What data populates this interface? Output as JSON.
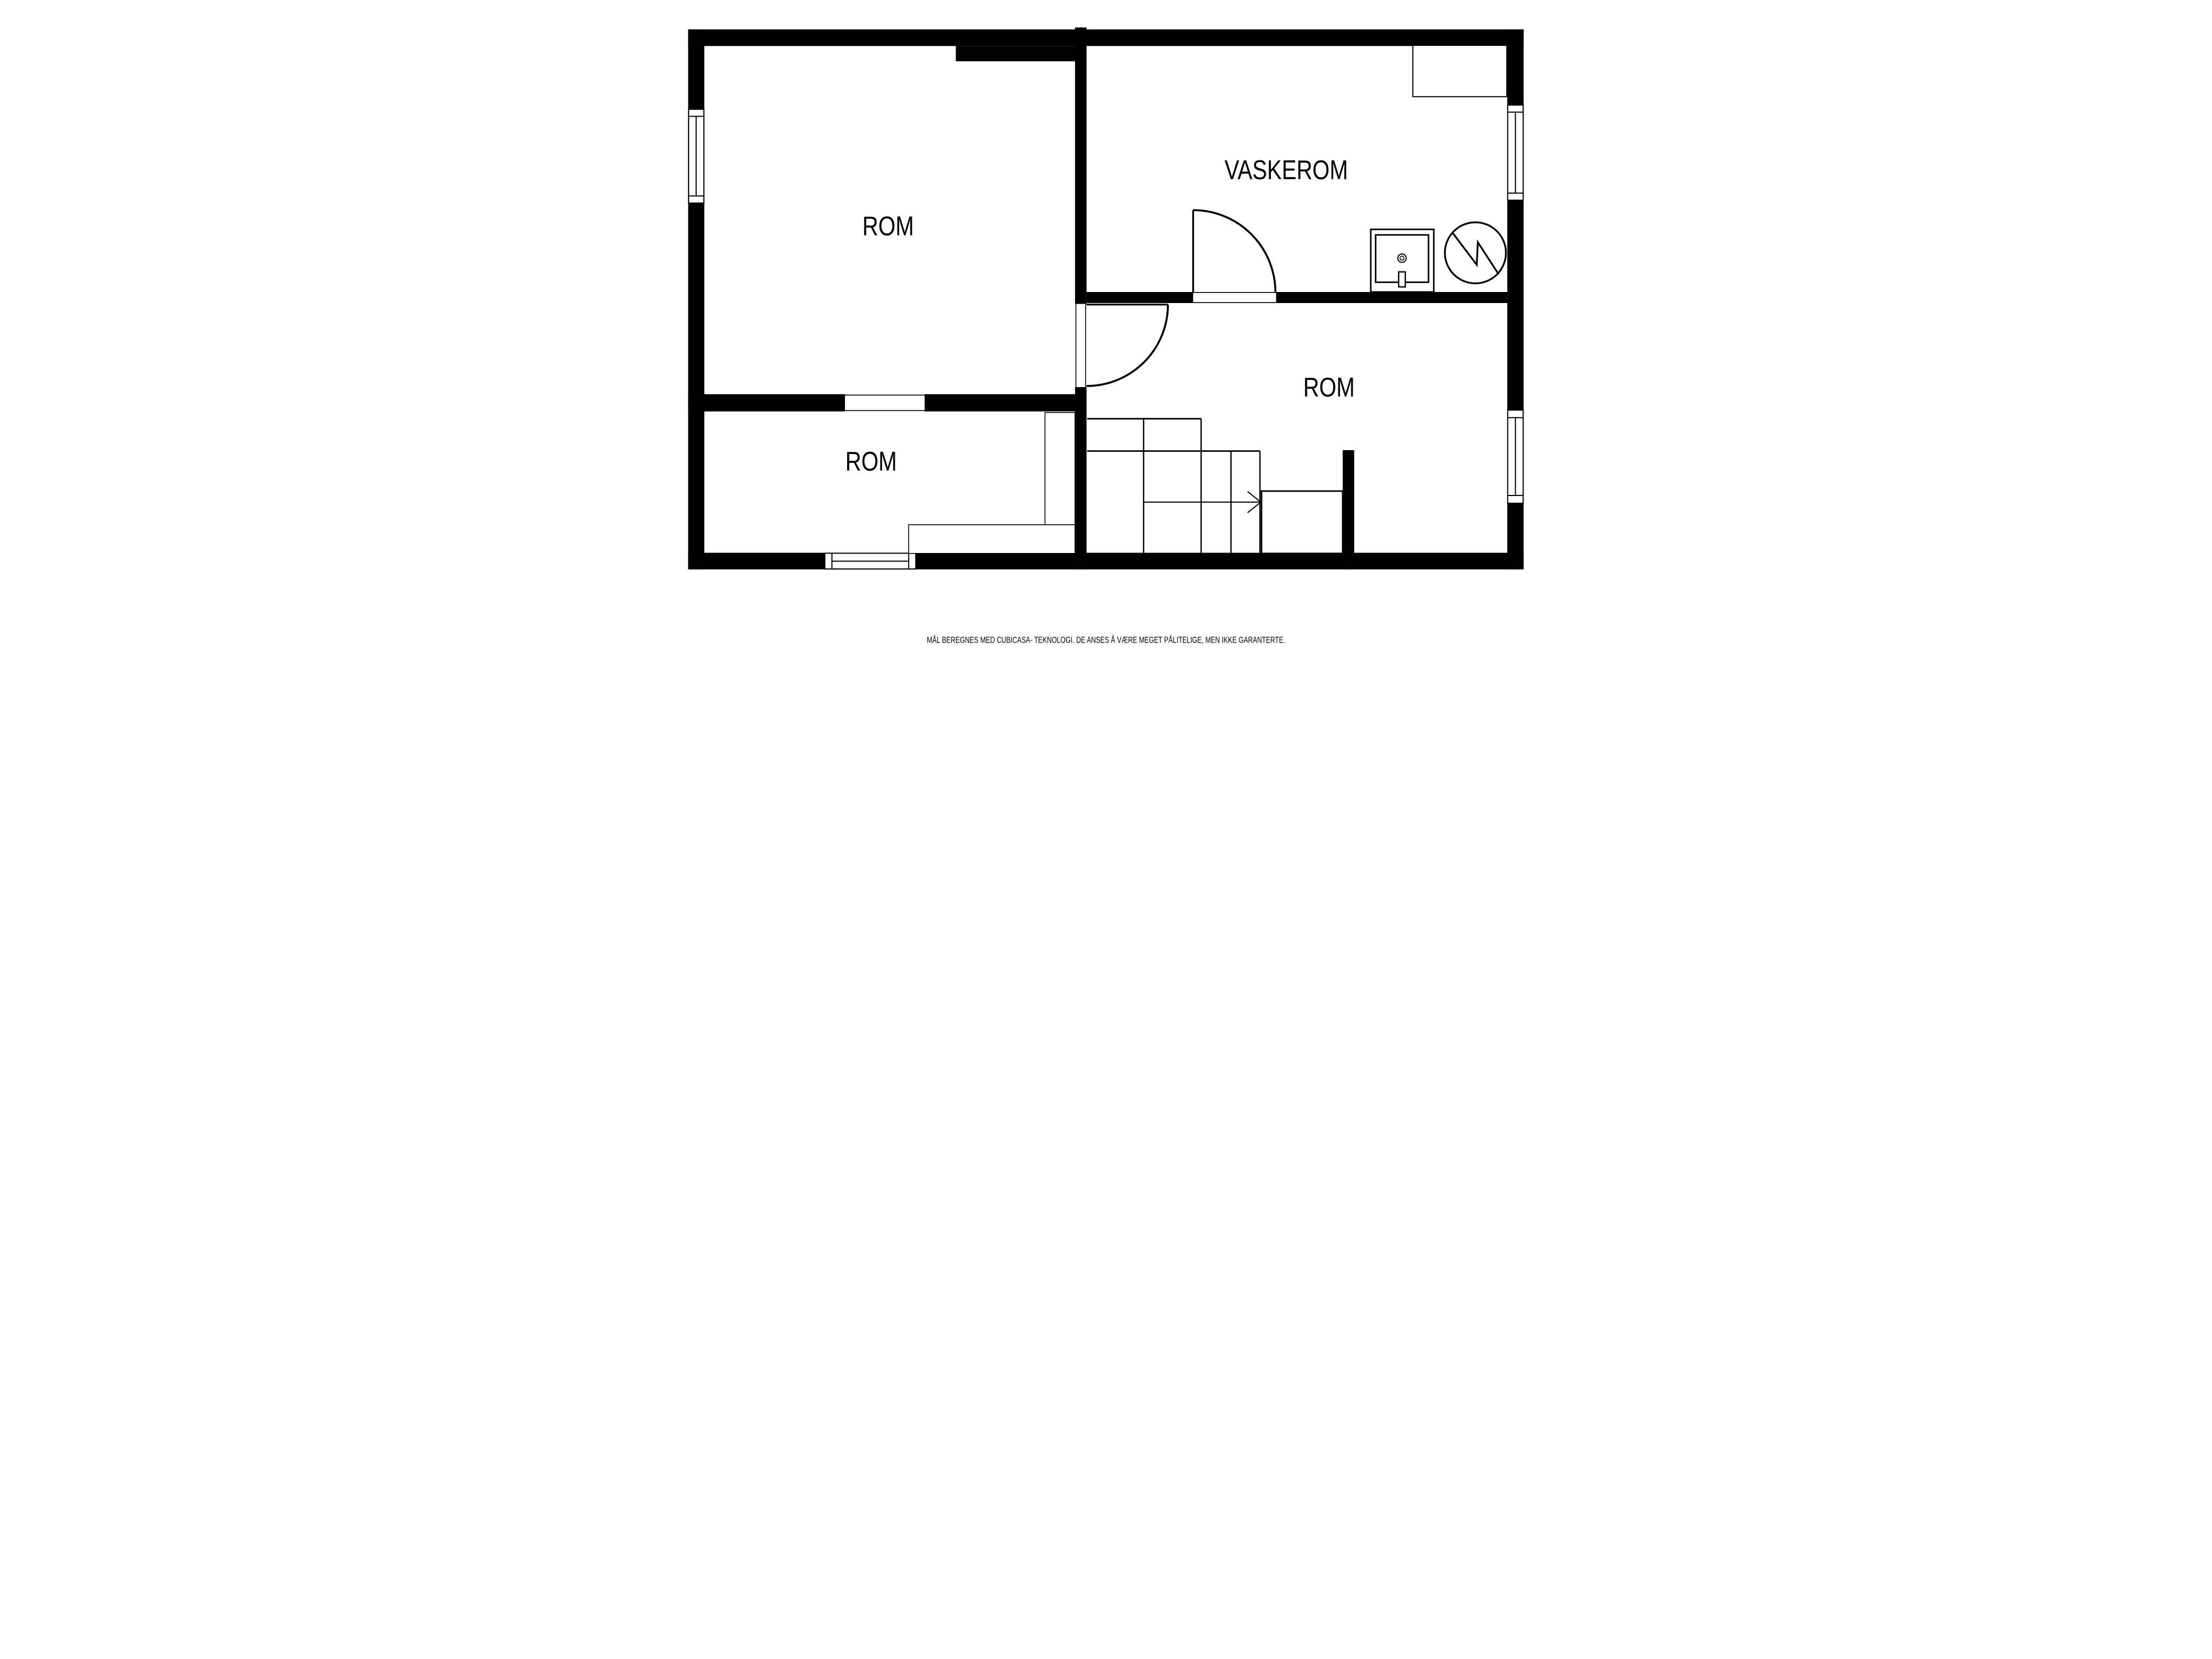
{
  "plan": {
    "type": "floor-plan",
    "colors": {
      "wall": "#000000",
      "background": "#ffffff",
      "line": "#000000"
    },
    "rooms": [
      {
        "key": "room-top-left",
        "label": "ROM"
      },
      {
        "key": "vaskerom",
        "label": "VASKEROM"
      },
      {
        "key": "room-right",
        "label": "ROM"
      },
      {
        "key": "room-bottom-left",
        "label": "ROM"
      }
    ],
    "fixtures": [
      {
        "name": "sink-icon"
      },
      {
        "name": "water-heater-icon"
      },
      {
        "name": "stairs"
      },
      {
        "name": "stairs-direction-arrow"
      },
      {
        "name": "window",
        "count": 4
      },
      {
        "name": "door-arc",
        "count": 2
      },
      {
        "name": "closet",
        "count": 4
      }
    ],
    "footer": {
      "disclaimer": "MÅL BEREGNES MED CUBICASA- TEKNOLOGI. DE ANSES Å VÆRE MEGET PÅLITELIGE, MEN IKKE GARANTERTE."
    }
  }
}
